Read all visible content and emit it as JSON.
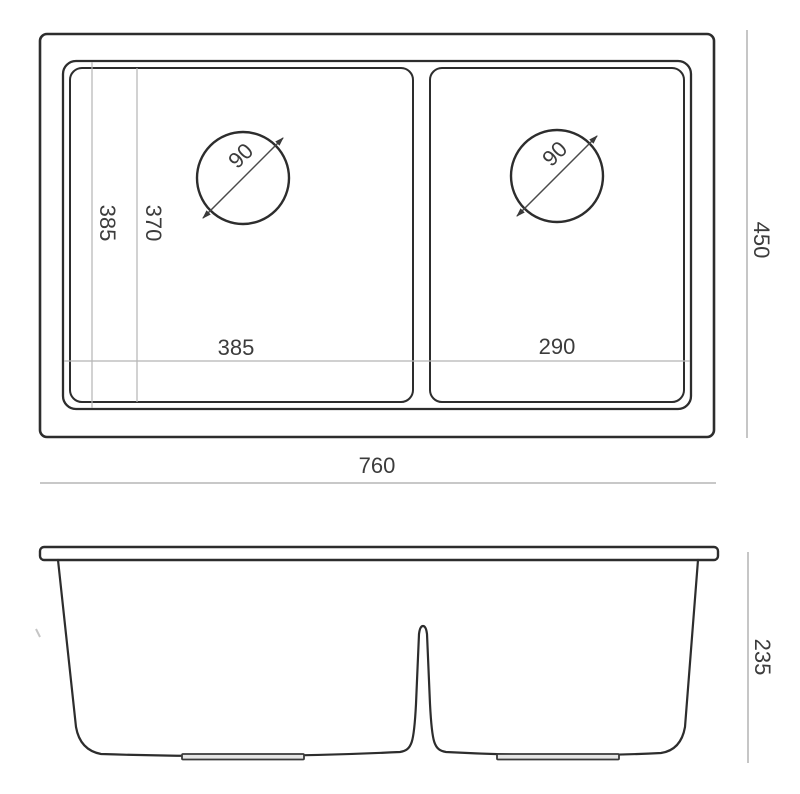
{
  "drawing": {
    "type": "sink-technical-drawing",
    "colors": {
      "outline": "#2d2d2d",
      "dimension_line": "#a8a8a8",
      "dimension_text": "#3c3c3c",
      "background": "#ffffff"
    },
    "top_view": {
      "overall_width": "760",
      "overall_depth": "450",
      "rim_front_to_back": "385",
      "bowl_front_to_back": "370",
      "left_bowl_width": "385",
      "right_bowl_width": "290",
      "left_drain_diameter": "90",
      "right_drain_diameter": "90"
    },
    "front_view": {
      "overall_height": "235"
    }
  }
}
